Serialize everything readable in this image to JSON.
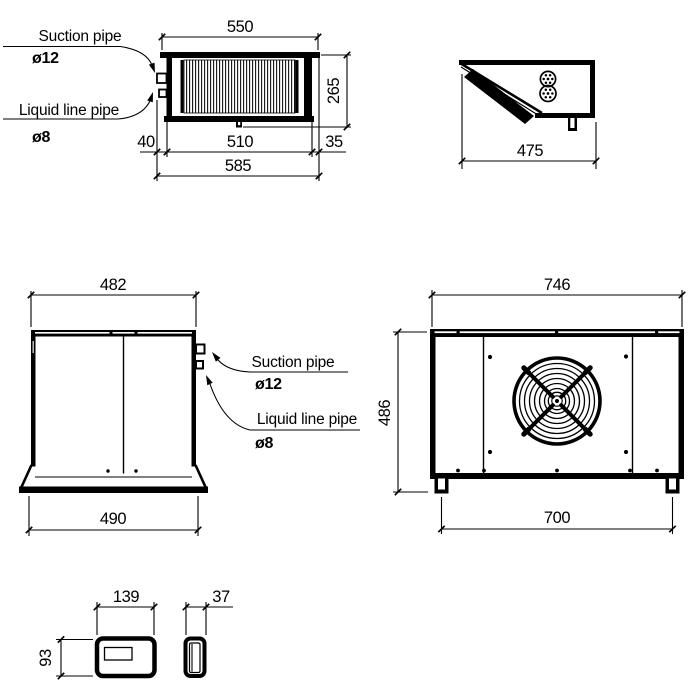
{
  "drawing": {
    "callouts": {
      "suction": {
        "label": "Suction pipe",
        "diameter": "ø12"
      },
      "liquid": {
        "label": "Liquid line pipe",
        "diameter": "ø8"
      }
    },
    "top_view": {
      "dim_top_width": "550",
      "dim_height": "265",
      "dim_left_offset": "40",
      "dim_body_width": "510",
      "dim_right_offset": "35",
      "dim_total_width": "585"
    },
    "profile_view": {
      "dim_depth": "475"
    },
    "side_view": {
      "dim_top_width": "482",
      "dim_bottom_width": "490"
    },
    "front_view": {
      "dim_top_width": "746",
      "dim_height": "486",
      "dim_feet_span": "700"
    },
    "controller_front": {
      "dim_width": "139",
      "dim_height": "93"
    },
    "controller_side": {
      "dim_width": "37"
    }
  }
}
